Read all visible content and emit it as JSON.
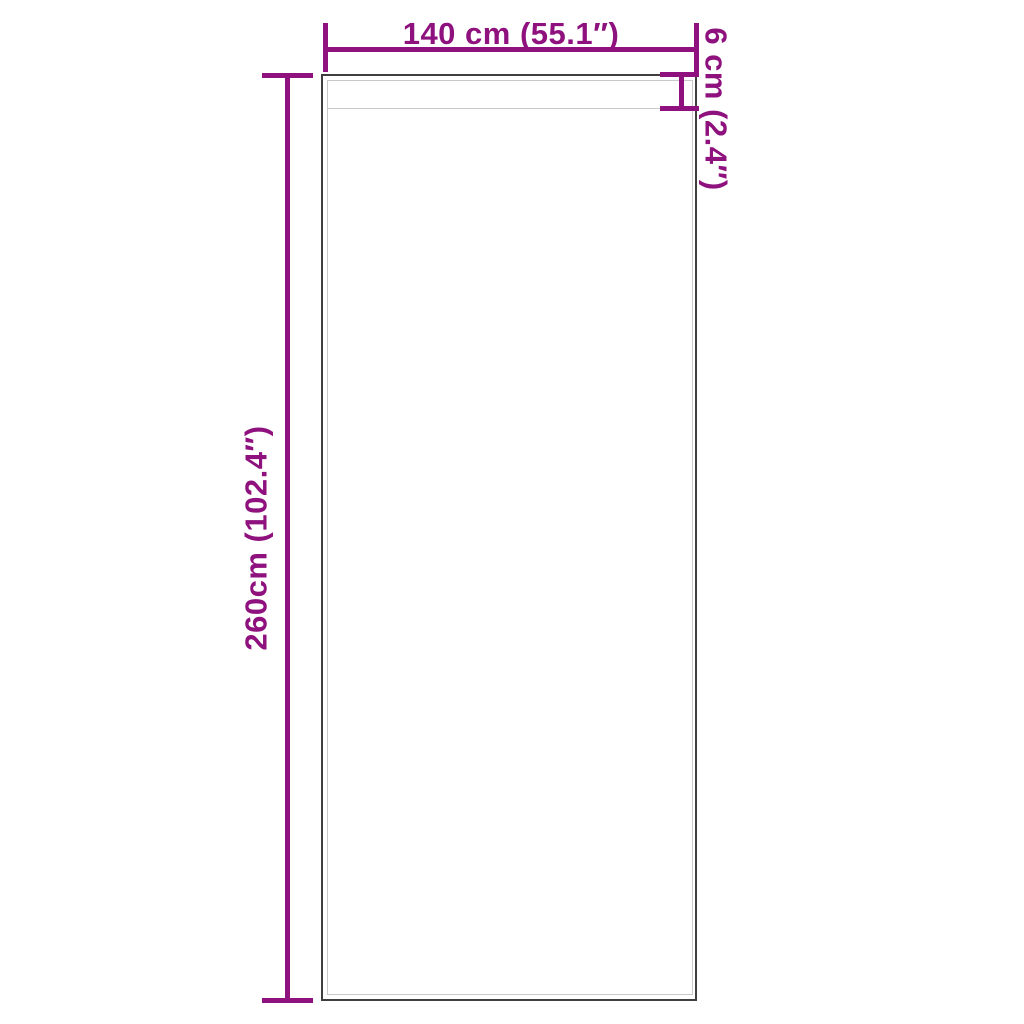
{
  "labels": {
    "width": "140 cm (55.1″)",
    "height": "260cm (102.4″)",
    "pocket_depth": "6 cm (2.4″)"
  },
  "colors": {
    "dimension_accent": "#8E117E",
    "outline_dark": "#3F3F3F",
    "outline_light": "#C9C9C9",
    "background": "#FFFFFF"
  }
}
